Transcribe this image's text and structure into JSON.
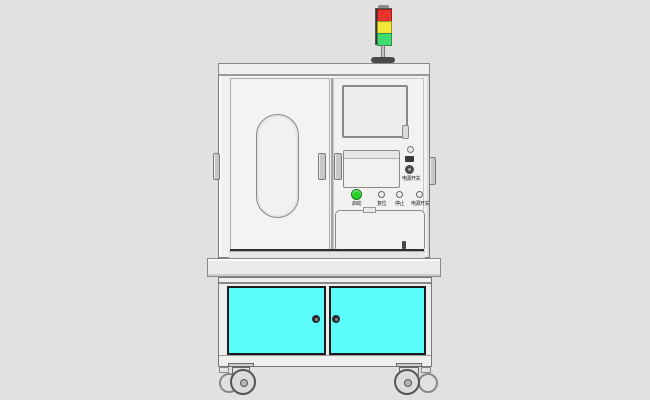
{
  "scene": {
    "description": "CAD render of an industrial equipment cabinet with signal tower, control panel and cyan storage doors",
    "background_color": "#e3e0e0",
    "body_color": "#f3f1f0",
    "outline_color": "#7a7878"
  },
  "tower_light": {
    "segments": [
      {
        "name": "red",
        "color": "#e8332d"
      },
      {
        "name": "yellow",
        "color": "#f2e636"
      },
      {
        "name": "green",
        "color": "#3fdc72"
      }
    ]
  },
  "control_panel": {
    "side_label": "电源开关",
    "buttons": [
      {
        "label": "启动",
        "color": "#27d127"
      },
      {
        "label": "复位",
        "color": "#f0eeed"
      },
      {
        "label": "停止",
        "color": "#f0eeed"
      },
      {
        "label": "电源开关",
        "color": "#f0eeed"
      }
    ]
  },
  "lower_cabinet": {
    "door_color": "#5cfdfd",
    "knob_color": "#2b2b2b"
  }
}
